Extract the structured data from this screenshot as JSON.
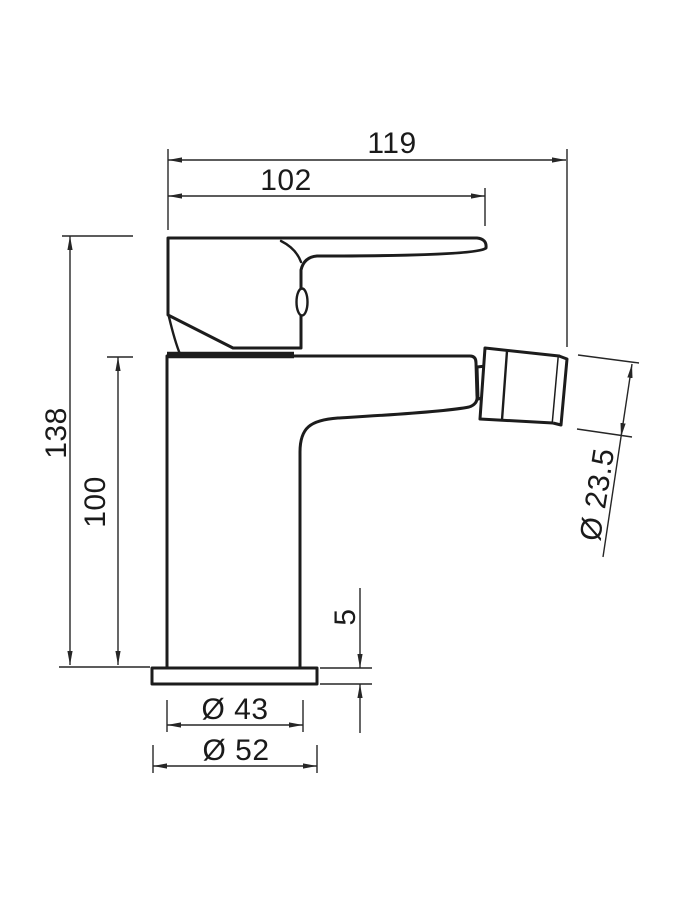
{
  "drawing": {
    "subject": "bidet-mixer-tap-side-elevation",
    "colors": {
      "line": "#1c1c1c",
      "dimension": "#262626",
      "background": "#ffffff"
    }
  },
  "dims": {
    "overall_depth": "119",
    "spout_projection": "102",
    "overall_height": "138",
    "body_height": "100",
    "aerator_diameter": "Ø 23.5",
    "base_plate_thickness": "5",
    "body_diameter": "Ø 43",
    "base_plate_diameter": "Ø 52"
  }
}
